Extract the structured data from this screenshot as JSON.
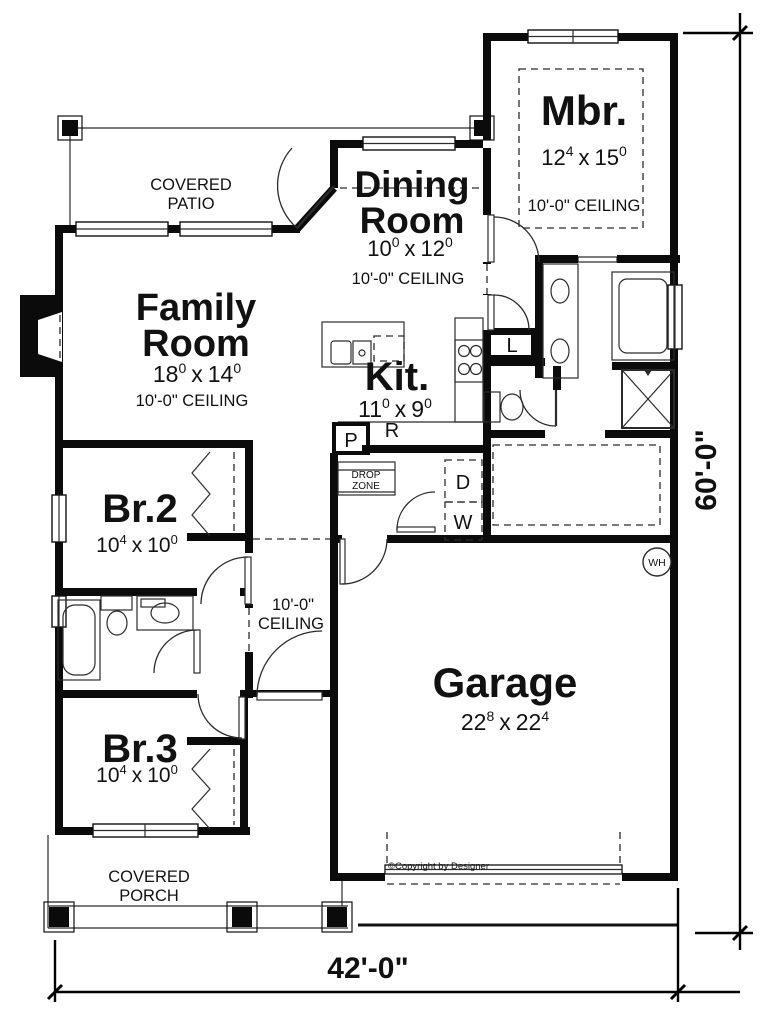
{
  "plan": {
    "rooms": {
      "mbr": {
        "name": "Mbr.",
        "dim_a": "12",
        "dim_a_sup": "4",
        "dim_x": "x",
        "dim_b": "15",
        "dim_b_sup": "0",
        "ceiling": "10'-0\" CEILING"
      },
      "dining": {
        "name1": "Dining",
        "name2": "Room",
        "dim_a": "10",
        "dim_a_sup": "0",
        "dim_x": "x",
        "dim_b": "12",
        "dim_b_sup": "0",
        "ceiling": "10'-0\" CEILING"
      },
      "family": {
        "name1": "Family",
        "name2": "Room",
        "dim_a": "18",
        "dim_a_sup": "0",
        "dim_x": "x",
        "dim_b": "14",
        "dim_b_sup": "0",
        "ceiling": "10'-0\" CEILING"
      },
      "kitchen": {
        "name": "Kit.",
        "dim_a": "11",
        "dim_a_sup": "0",
        "dim_x": "x",
        "dim_b": "9",
        "dim_b_sup": "0"
      },
      "br2": {
        "name": "Br.2",
        "dim_a": "10",
        "dim_a_sup": "4",
        "dim_x": "x",
        "dim_b": "10",
        "dim_b_sup": "0"
      },
      "br3": {
        "name": "Br.3",
        "dim_a": "10",
        "dim_a_sup": "4",
        "dim_x": "x",
        "dim_b": "10",
        "dim_b_sup": "0"
      },
      "garage": {
        "name": "Garage",
        "dim_a": "22",
        "dim_a_sup": "8",
        "dim_x": "x",
        "dim_b": "22",
        "dim_b_sup": "4"
      }
    },
    "hall": {
      "ceiling1": "10'-0\"",
      "ceiling2": "CEILING"
    },
    "outdoor": {
      "patio1": "COVERED",
      "patio2": "PATIO",
      "porch1": "COVERED",
      "porch2": "PORCH"
    },
    "labels": {
      "pantry": "P",
      "range": "R",
      "dryer": "D",
      "washer": "W",
      "linen": "L",
      "water_heater": "WH",
      "drop1": "DROP",
      "drop2": "ZONE"
    },
    "dimensions": {
      "width": "42'-0\"",
      "depth": "60'-0\""
    },
    "copyright": "©Copyright by Designer",
    "colors": {
      "wall": "#0b0b0b",
      "line": "#2b2b2b",
      "copyright_text": "#666666"
    }
  }
}
